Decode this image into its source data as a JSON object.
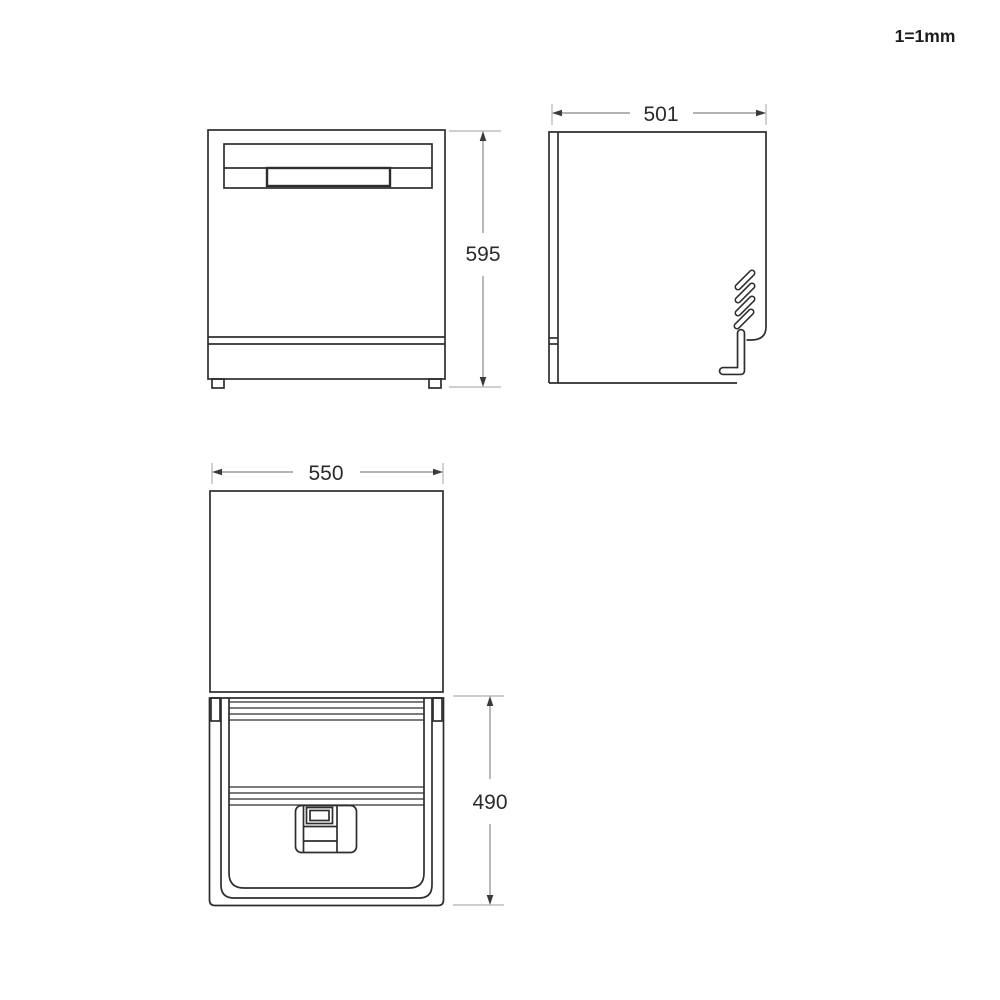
{
  "scale_note": "1=1mm",
  "unit": "mm",
  "views": {
    "front": {
      "label": "front-view",
      "height_mm": "595"
    },
    "side": {
      "label": "side-view",
      "width_mm": "501"
    },
    "plan": {
      "label": "top-view-door-open",
      "width_mm": "550",
      "door_depth_mm": "490"
    }
  },
  "dimensions": [
    {
      "view": "front",
      "axis": "vertical",
      "value": 595,
      "unit": "mm"
    },
    {
      "view": "side",
      "axis": "horizontal",
      "value": 501,
      "unit": "mm"
    },
    {
      "view": "plan",
      "axis": "horizontal",
      "value": 550,
      "unit": "mm"
    },
    {
      "view": "plan",
      "axis": "vertical",
      "value": 490,
      "unit": "mm"
    }
  ],
  "colors": {
    "background": "#ffffff",
    "line": "#2e2e2e",
    "dimension_line": "#9a9a9a",
    "extension_line": "#bdbdbd",
    "text": "#2b2b2b"
  }
}
